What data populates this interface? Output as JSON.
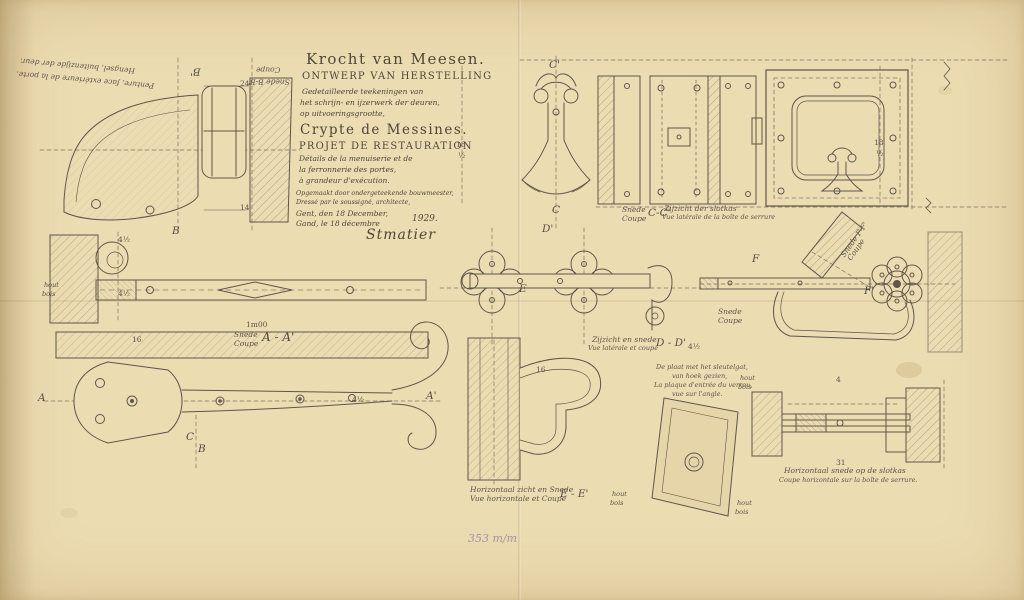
{
  "palette": {
    "paper": "#ecdcb2",
    "ink": "#5d5446",
    "pencil": "#9a7d9d"
  },
  "title_block": {
    "nl_title": "Krocht van Meesen.",
    "nl_subtitle": "ONTWERP VAN HERSTELLING",
    "nl_line1": "Gedetailleerde teekeningen van",
    "nl_line2": "het schrijn- en ijzerwerk der deuren,",
    "nl_line3": "op uitvoeringsgrootte,",
    "fr_title": "Crypte de Messines.",
    "fr_subtitle": "PROJET DE RESTAURATION",
    "fr_line1": "Détails de la menuiserie et de",
    "fr_line2": "la ferronnerie des portes,",
    "fr_line3": "à grandeur d'exécution.",
    "made_nl": "Opgemaakt door ondergeteekende bouwmeester,",
    "made_fr": "Dressé par le soussigné, architecte,",
    "date_nl": "Gent, den 18 December,",
    "date_fr": "Gand, le 18 décembre",
    "year": "1929.",
    "signature": "Stmatier"
  },
  "labels": {
    "penture_nl": "Hengsel, buitenzijde der deur.",
    "penture_fr": "Penture, face extérieure de la porte.",
    "snede_bb": "Snede B-B'",
    "coupe_bb": "Coupe",
    "scale": "1m00",
    "snede_aa_nl": "Snede",
    "snede_aa_fr": "Coupe",
    "aa": "A - A'",
    "snede_cc_nl": "Snede",
    "snede_cc_fr": "Coupe",
    "cc": "C-C'",
    "zijzicht_slotkas_nl": "Zijzicht der slotkas",
    "zijzicht_slotkas_fr": "Vue latérale de la boîte de serrure",
    "snede_ff_nl": "Snede F-F'",
    "snede_ff_fr": "Coupe",
    "snede2_nl": "Snede",
    "snede2_fr": "Coupe",
    "zijzicht_dd_nl": "Zijzicht en snede",
    "zijzicht_dd_fr": "Vue latérale et coupe",
    "dd": "D - D'",
    "plaat_note_1": "De plaat met het sleutelgat,",
    "plaat_note_2": "van hoek gezien,",
    "plaat_note_3": "La plaque d'entrée du verrou,",
    "plaat_note_4": "vue sur l'angle.",
    "horiz_e_nl": "Horizontaal zicht en Snede",
    "horiz_e_fr": "Vue horizontale et Coupe",
    "ee": "E - E'",
    "horiz_slot_nl": "Horizontaal snede op de slotkas",
    "horiz_slot_fr": "Coupe horizontale sur la boîte de serrure.",
    "hout1_nl": "hout",
    "hout1_fr": "bois",
    "hout2_nl": "hout",
    "hout2_fr": "bois",
    "hout3_nl": "hout",
    "hout3_fr": "bois",
    "hout4_nl": "hout",
    "hout4_fr": "bois"
  },
  "marks": {
    "a": "A",
    "a_prime": "A'",
    "b": "B",
    "b_prime": "B'",
    "b2": "B",
    "c": "C",
    "c2": "C",
    "c_prime": "C'",
    "d_prime": "D'",
    "e": "E",
    "f": "F",
    "f_prime": "F'"
  },
  "dimensions": {
    "d24": "24",
    "d14": "14",
    "d45a": "4½",
    "d45b": "4½",
    "d45c": "4½",
    "d45d": "4½",
    "d16a": "16",
    "d16b": "16",
    "d18a": "18",
    "d18a2": "½",
    "d18b": "18",
    "d18b2": "½",
    "d31": "31",
    "d4": "4"
  },
  "pencil_note": "353 m/m"
}
